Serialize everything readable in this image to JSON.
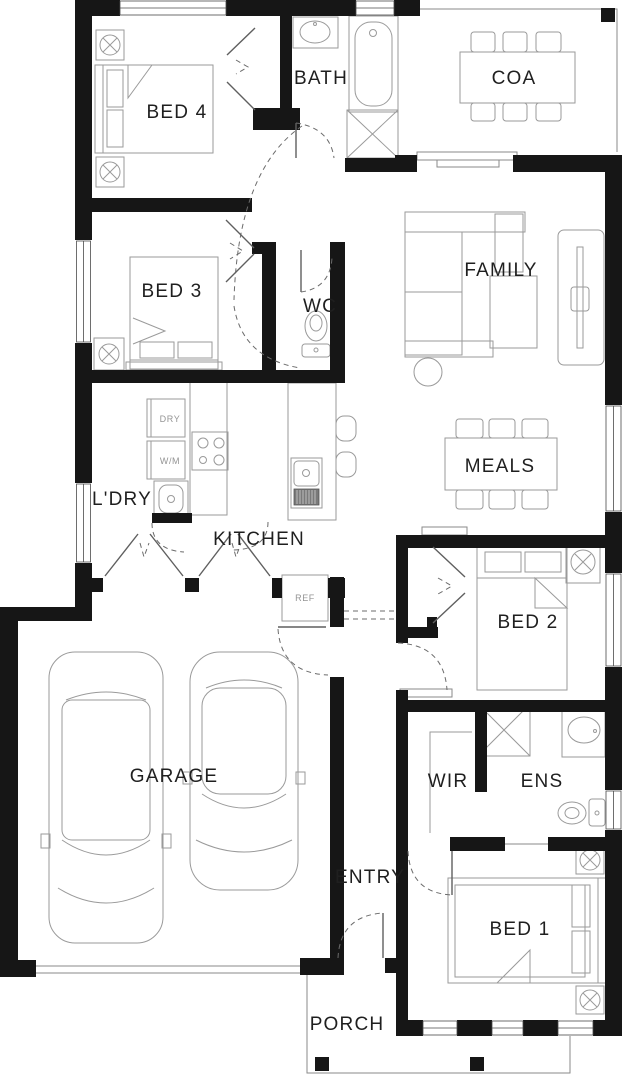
{
  "floor_plan": {
    "rooms": [
      {
        "id": "bed4",
        "label": "BED 4"
      },
      {
        "id": "bath",
        "label": "BATH"
      },
      {
        "id": "coa",
        "label": "COA"
      },
      {
        "id": "family",
        "label": "FAMILY"
      },
      {
        "id": "bed3",
        "label": "BED 3"
      },
      {
        "id": "wc",
        "label": "WC"
      },
      {
        "id": "ldry",
        "label": "L'DRY"
      },
      {
        "id": "kitchen",
        "label": "KITCHEN"
      },
      {
        "id": "meals",
        "label": "MEALS"
      },
      {
        "id": "bed2",
        "label": "BED 2"
      },
      {
        "id": "garage",
        "label": "GARAGE"
      },
      {
        "id": "wir",
        "label": "WIR"
      },
      {
        "id": "ens",
        "label": "ENS"
      },
      {
        "id": "entry",
        "label": "ENTRY"
      },
      {
        "id": "bed1",
        "label": "BED 1"
      },
      {
        "id": "porch",
        "label": "PORCH"
      }
    ],
    "appliance_labels": {
      "dryer": "DRY",
      "washing_machine": "W/M",
      "fridge": "REF"
    },
    "colors": {
      "walls": "#161616",
      "furniture_line": "#9a9a9a",
      "door_line": "#6b6b6b",
      "background": "#ffffff"
    }
  }
}
